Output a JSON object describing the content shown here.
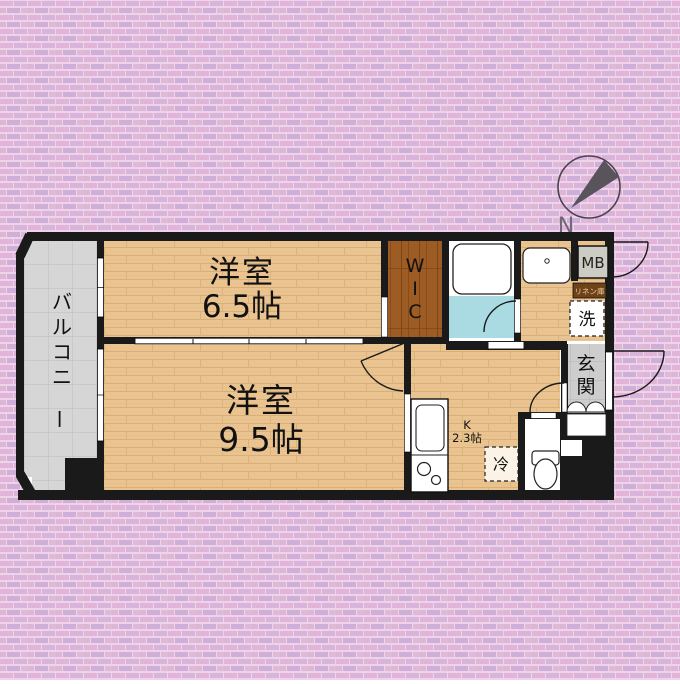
{
  "compass": {
    "north": "N"
  },
  "rooms": {
    "room1": {
      "name": "洋室",
      "size": "6.5帖"
    },
    "room2": {
      "name": "洋室",
      "size": "9.5帖"
    },
    "balcony": {
      "name": "バルコニー"
    },
    "wic": {
      "name": "WIC"
    },
    "kitchen": {
      "label": "K",
      "size": "2.3帖"
    },
    "entrance": {
      "name": "玄関"
    }
  },
  "fixtures": {
    "meter_box": "MB",
    "linen_closet": "リネン庫",
    "washer": "洗",
    "refrigerator": "冷"
  },
  "colors": {
    "background_brick": "#eccfe7",
    "brick_accent": "#ddb0d7",
    "brick_accent2": "#c9abd9",
    "wall": "#1a1a1a",
    "wood_floor": "#eac490",
    "wood_seam": "#d9ae77",
    "wic_floor": "#9c5c24",
    "wic_seam": "#7d4517",
    "balcony_tile": "#d6d6d6",
    "tile_line": "#bcbcbc",
    "genkan_tile": "#cdcdcd",
    "bath_floor": "#aadbe3",
    "meter_box_fill": "#ccccc2",
    "linen_fill": "#6e431a",
    "linen_text": "#eecb9b",
    "compass_gray": "#59535c"
  }
}
